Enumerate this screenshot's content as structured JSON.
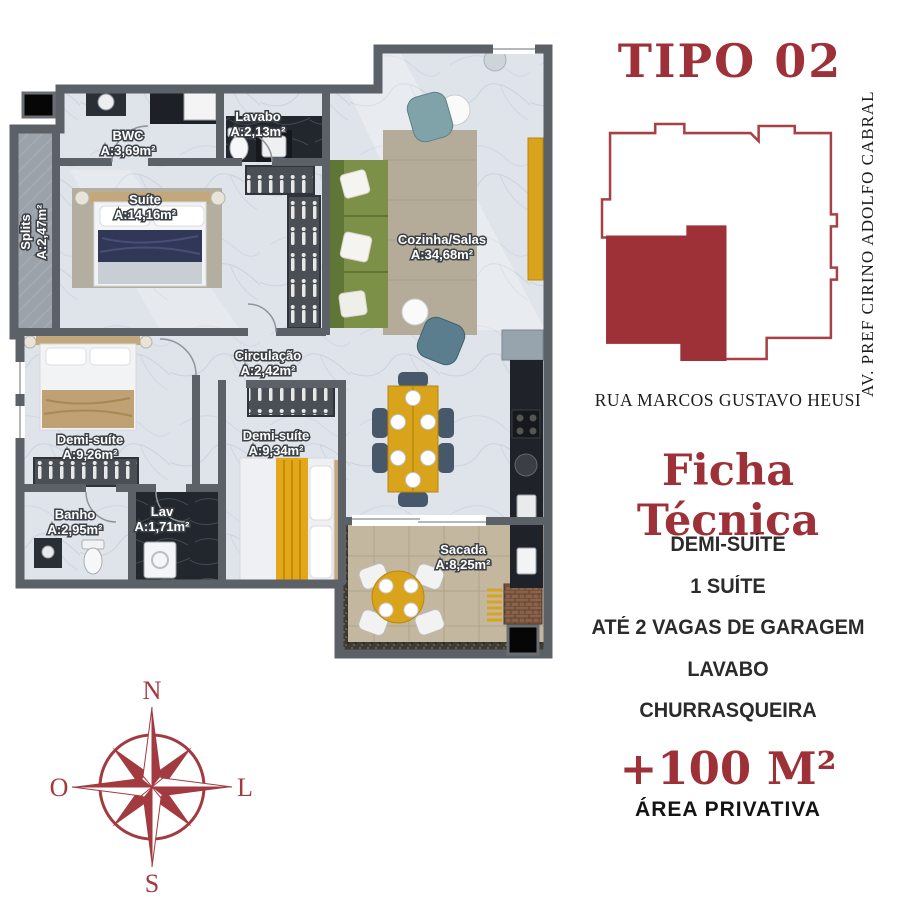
{
  "title": "TIPO 02",
  "location_map": {
    "street_right": "AV. PREF CIRINO ADOLFO CABRAL",
    "street_bottom": "RUA MARCOS GUSTAVO HEUSI",
    "accent_color": "#9e3038"
  },
  "ficha": {
    "heading": "Ficha Técnica",
    "items": [
      "DEMI-SUÍTE",
      "1 SUÍTE",
      "ATÉ 2 VAGAS DE GARAGEM",
      "LAVABO",
      "CHURRASQUEIRA"
    ]
  },
  "area": {
    "value": "+100 M²",
    "label": "ÁREA PRIVATIVA"
  },
  "compass": {
    "n": "N",
    "s": "S",
    "w": "O",
    "e": "L"
  },
  "plan": {
    "rooms": [
      {
        "name": "BWC",
        "area": "A:3,69m²"
      },
      {
        "name": "Lavabo",
        "area": "A:2,13m²"
      },
      {
        "name": "Suíte",
        "area": "A:14,16m²"
      },
      {
        "name": "Splits",
        "area": "A:2,47m²"
      },
      {
        "name": "Cozinha/Salas",
        "area": "A:34,68m²"
      },
      {
        "name": "Circulação",
        "area": "A:2,42m²"
      },
      {
        "name": "Demi-suíte",
        "area": "A:9,26m²"
      },
      {
        "name": "Demi-suíte",
        "area": "A:9,34m²"
      },
      {
        "name": "Banho",
        "area": "A:2,95m²"
      },
      {
        "name": "Lav",
        "area": "A:1,71m²"
      },
      {
        "name": "Sacada",
        "area": "A:8,25m²"
      }
    ]
  }
}
